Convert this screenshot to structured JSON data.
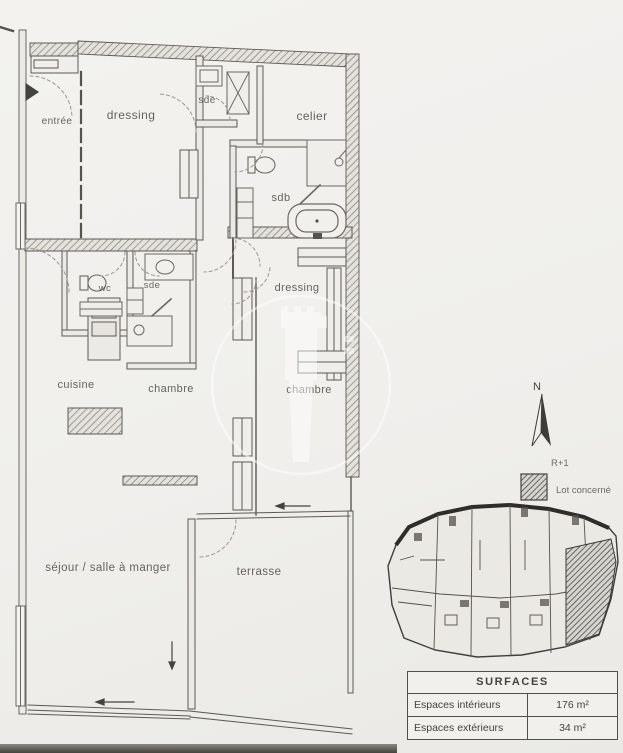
{
  "page": {
    "bg": "#f0efec"
  },
  "plan": {
    "rooms": [
      {
        "id": "entree",
        "label": "entrée"
      },
      {
        "id": "dressing-top",
        "label": "dressing"
      },
      {
        "id": "sde-top",
        "label": "sde"
      },
      {
        "id": "celier",
        "label": "celier"
      },
      {
        "id": "sdb",
        "label": "sdb"
      },
      {
        "id": "wc",
        "label": "wc"
      },
      {
        "id": "sde-mid",
        "label": "sde"
      },
      {
        "id": "dressing-right",
        "label": "dressing"
      },
      {
        "id": "cuisine",
        "label": "cuisine"
      },
      {
        "id": "chambre-1",
        "label": "chambre"
      },
      {
        "id": "chambre-2",
        "label": "chambre"
      },
      {
        "id": "sejour",
        "label": "séjour / salle à manger"
      },
      {
        "id": "terrasse",
        "label": "terrasse"
      }
    ]
  },
  "compass": {
    "label": "N"
  },
  "legend": {
    "level": "R+1",
    "lot_label": "Lot concerné",
    "swatch_icon": "hatched-lot-swatch"
  },
  "watermark": {
    "icon": "lighthouse-watermark-icon"
  },
  "surfaces": {
    "title": "SURFACES",
    "rows": [
      {
        "label": "Espaces intérieurs",
        "value": "176 m²"
      },
      {
        "label": "Espaces extérieurs",
        "value": "34 m²"
      }
    ]
  }
}
